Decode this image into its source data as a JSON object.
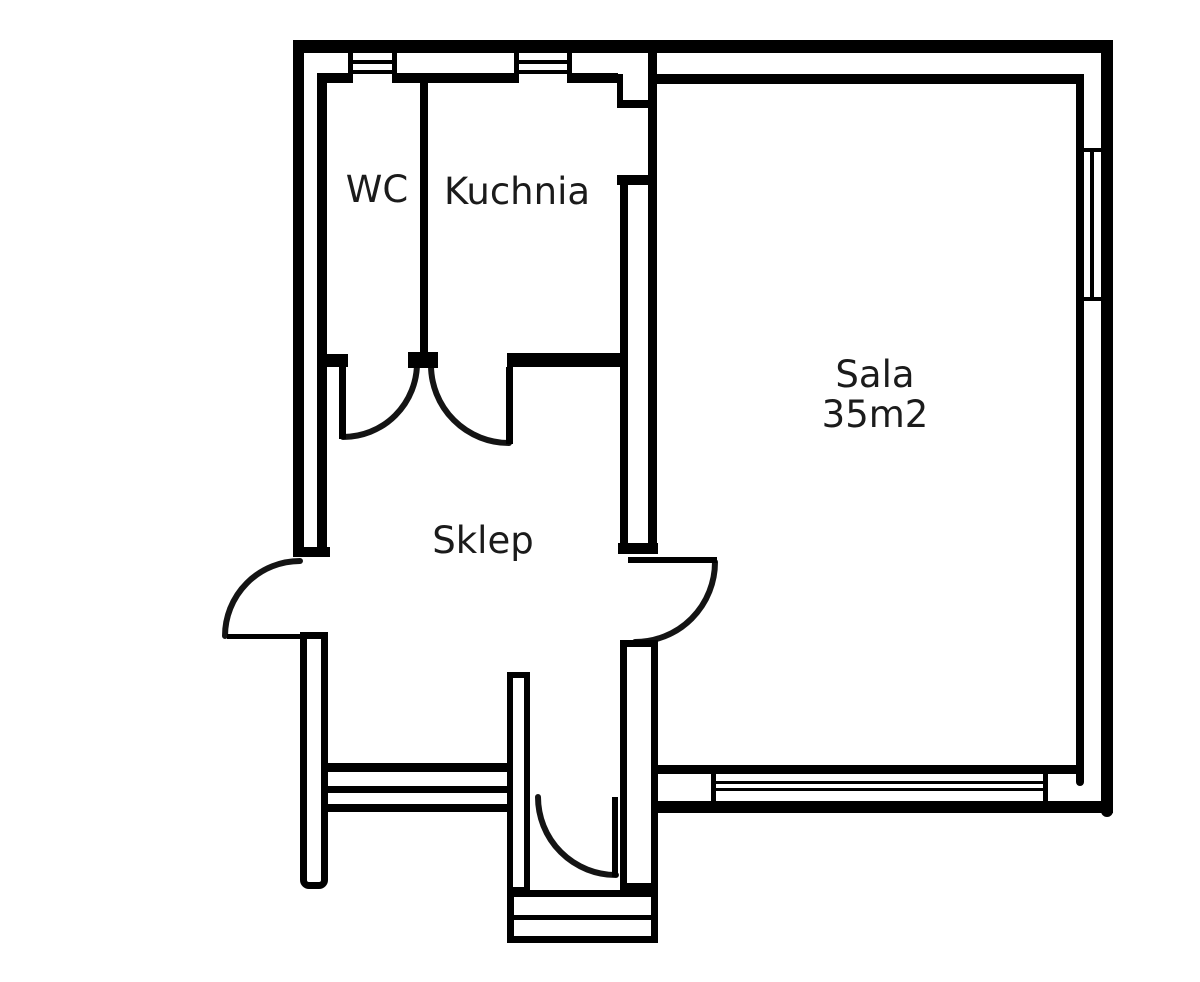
{
  "floorplan": {
    "background": "#ffffff",
    "wall_color": "#000000",
    "text_color": "#1b1b1b",
    "rooms": {
      "wc": {
        "label": "WC"
      },
      "kuchnia": {
        "label": "Kuchnia"
      },
      "sala": {
        "label": "Sala",
        "area": "35m2"
      },
      "sklep": {
        "label": "Sklep"
      }
    },
    "features": {
      "doors": 5,
      "windows_top": 2,
      "window_right": 1,
      "storefront_windows_bottom": 2
    }
  }
}
